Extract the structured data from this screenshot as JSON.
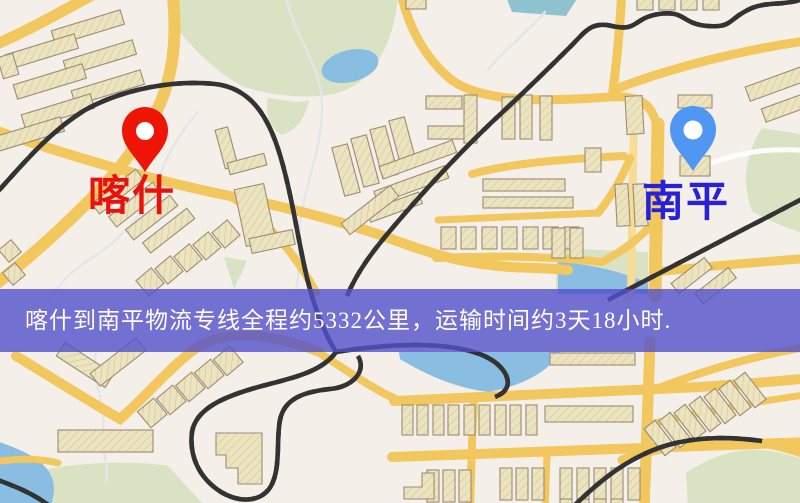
{
  "banner": {
    "text": "喀什到南平物流专线全程约5332公里，运输时间约3天18小时.",
    "background": "#5250cb",
    "text_color": "#ffffff"
  },
  "markers": {
    "origin": {
      "label": "喀什",
      "pin_color": "#ee1506",
      "pin_hole_color": "#ffffff",
      "label_color": "#e8120c"
    },
    "destination": {
      "label": "南平",
      "pin_color": "#4f97f2",
      "pin_hole_color": "#ffffff",
      "label_color": "#2722d8"
    }
  },
  "map": {
    "colors": {
      "land": "#f4efe9",
      "green": "#d9e3c4",
      "water": "#8abde2",
      "water_teal": "#8fc2cf",
      "road": "#f1c75e",
      "road_light": "#f6dd94",
      "building": "#ece3bf",
      "building_outline": "#9b8d72",
      "railway": "#333333",
      "stream": "#e3e6e8",
      "white_road": "#ffffff"
    }
  }
}
